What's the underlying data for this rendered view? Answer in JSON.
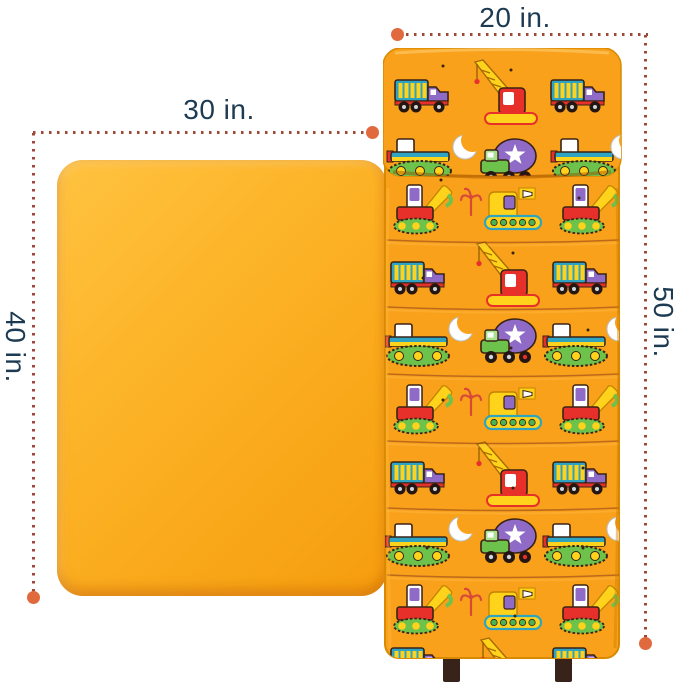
{
  "scene": {
    "kind": "nap mat and blanket dimension illustration",
    "background_color": "#ffffff"
  },
  "dimension_labels": {
    "mat_width": "20 in.",
    "blanket_width": "30 in.",
    "blanket_length": "40 in.",
    "mat_length": "50 in."
  },
  "colors": {
    "label_text": "#1c3a52",
    "dotted_line": "#9e4936",
    "endpoint_dot": "#e06a3e",
    "blanket_fill": "#fcb124",
    "mat_fill": "#f9a11b",
    "strap_fill": "#38231a",
    "seam_line": "#8a3c1e"
  },
  "pattern_motifs": [
    "dump-truck",
    "crane",
    "bulldozer",
    "cement-mixer",
    "steamroller",
    "excavator",
    "crescent-moon",
    "grapple-hook"
  ]
}
